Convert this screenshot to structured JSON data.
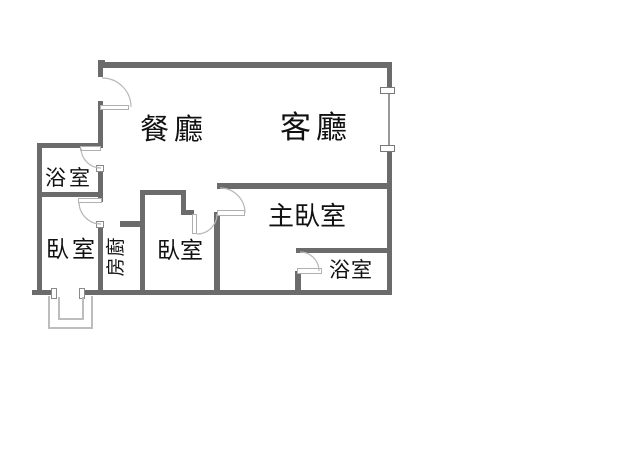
{
  "floorplan": {
    "rooms": {
      "dining": {
        "label": "餐廳"
      },
      "living": {
        "label": "客廳"
      },
      "master_bedroom": {
        "label": "主臥室"
      },
      "bedroom_left": {
        "label": "臥室"
      },
      "bedroom_middle": {
        "label": "臥室"
      },
      "bathroom_upper_left": {
        "label": "浴室"
      },
      "bathroom_lower_right": {
        "label": "浴室"
      },
      "kitchen": {
        "label": "廚房",
        "chars": [
          "廚",
          "房"
        ]
      }
    },
    "colors": {
      "wall": "#6b6b6b",
      "door_line": "#b8b8b8",
      "window_line": "#999999",
      "text": "#111111",
      "background": "#ffffff"
    }
  }
}
